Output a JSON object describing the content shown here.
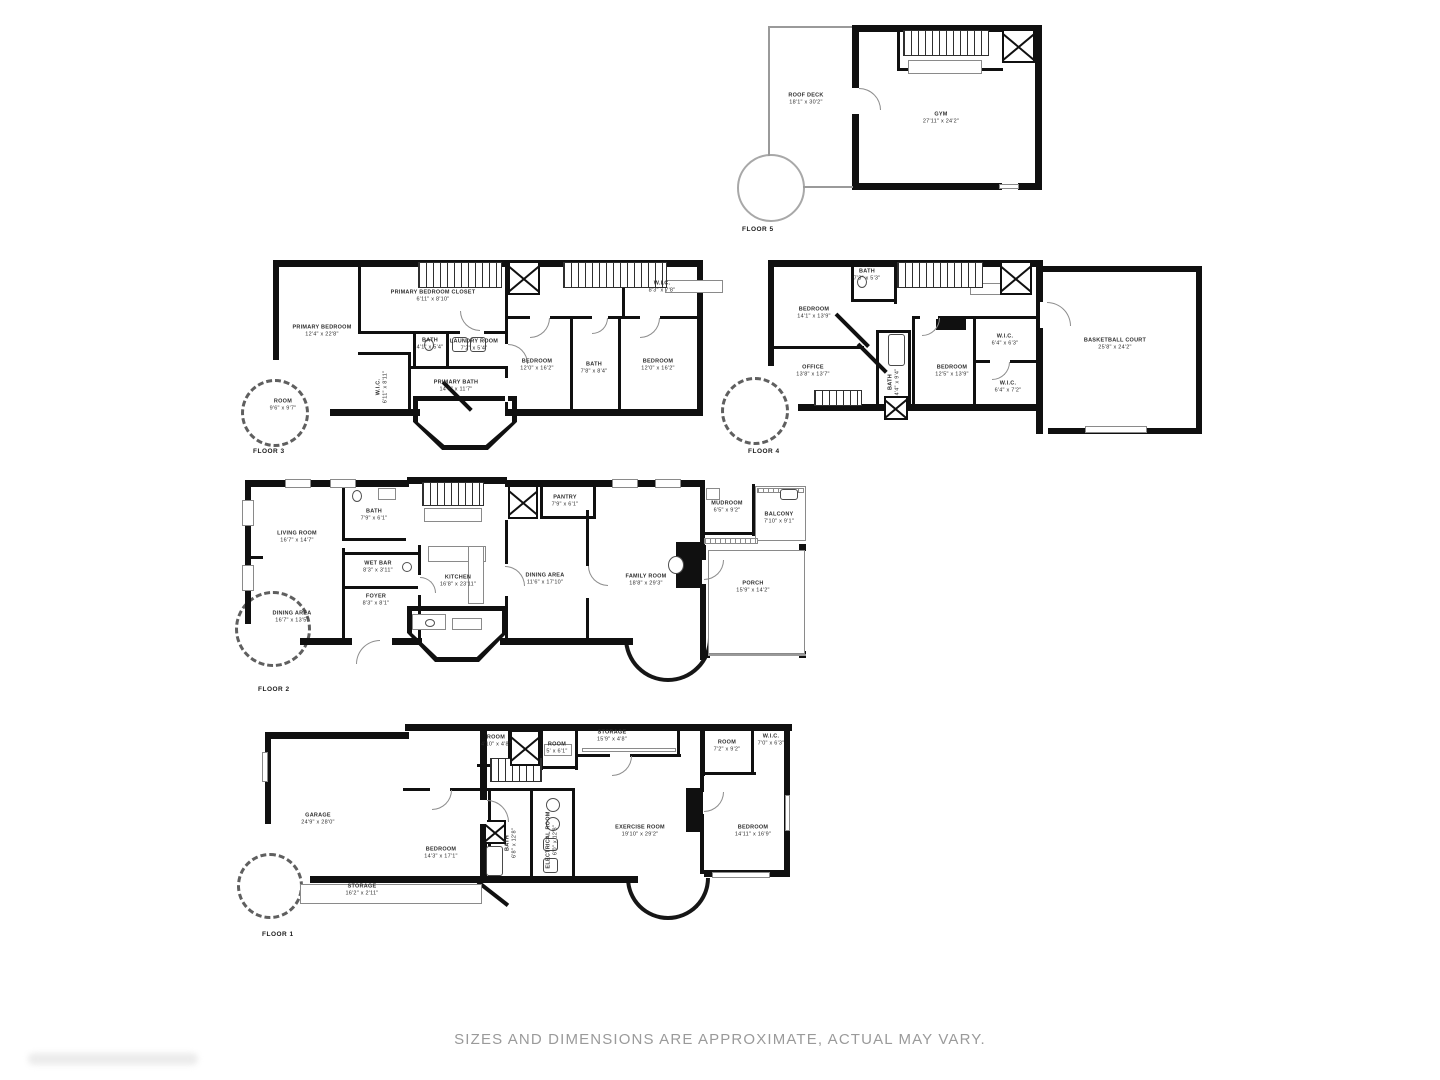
{
  "page": {
    "disclaimer": "SIZES AND DIMENSIONS ARE APPROXIMATE, ACTUAL MAY VARY."
  },
  "colors": {
    "wall": "#101010",
    "label": "#2d2d2d",
    "thin_line": "#9a9a9a",
    "disclaimer": "#9a9a9a",
    "background": "#ffffff"
  },
  "icons": {
    "elevator": "x-box-icon",
    "stairs": "hatched-stairs-icon",
    "door": "door-arc-icon",
    "bay_window": "bay-window-curve",
    "fixture": "bath-fixture-icon",
    "railing": "railing-grill-icon"
  },
  "floors": [
    {
      "id": "floor-5",
      "label": "FLOOR 5",
      "label_pos": [
        742,
        226
      ],
      "rooms": [
        {
          "name": "ROOF DECK",
          "dims": "18'1\" x 30'2\"",
          "x": 806,
          "y": 100
        },
        {
          "name": "GYM",
          "dims": "27'11\" x 24'2\"",
          "x": 941,
          "y": 119
        }
      ]
    },
    {
      "id": "floor-3",
      "label": "FLOOR 3",
      "label_pos": [
        253,
        448
      ],
      "rooms": [
        {
          "name": "PRIMARY BEDROOM",
          "dims": "12'4\" x 22'8\"",
          "x": 322,
          "y": 332
        },
        {
          "name": "PRIMARY BEDROOM CLOSET",
          "dims": "6'11\" x 8'10\"",
          "x": 433,
          "y": 297
        },
        {
          "name": "BATH",
          "dims": "4'1\" x 5'4\"",
          "x": 430,
          "y": 345
        },
        {
          "name": "LAUNDRY ROOM",
          "dims": "7'2\" x 5'4\"",
          "x": 474,
          "y": 346
        },
        {
          "name": "W.I.C.",
          "dims": "6'11\" x 8'11\"",
          "x": 383,
          "y": 387,
          "rot": true
        },
        {
          "name": "PRIMARY BATH",
          "dims": "14'6\" x 11'7\"",
          "x": 456,
          "y": 387
        },
        {
          "name": "ROOM",
          "dims": "9'6\" x 9'7\"",
          "x": 283,
          "y": 406
        },
        {
          "name": "BEDROOM",
          "dims": "12'0\" x 16'2\"",
          "x": 537,
          "y": 366
        },
        {
          "name": "BATH",
          "dims": "7'8\" x 8'4\"",
          "x": 594,
          "y": 369
        },
        {
          "name": "BEDROOM",
          "dims": "12'0\" x 16'2\"",
          "x": 658,
          "y": 366
        },
        {
          "name": "W.I.C.",
          "dims": "8'3\" x 7'8\"",
          "x": 662,
          "y": 288
        }
      ]
    },
    {
      "id": "floor-4",
      "label": "FLOOR 4",
      "label_pos": [
        748,
        448
      ],
      "rooms": [
        {
          "name": "BEDROOM",
          "dims": "14'1\" x 13'9\"",
          "x": 814,
          "y": 314
        },
        {
          "name": "BATH",
          "dims": "7'3\" x 5'3\"",
          "x": 867,
          "y": 276
        },
        {
          "name": "OFFICE",
          "dims": "13'8\" x 13'7\"",
          "x": 813,
          "y": 372
        },
        {
          "name": "BATH",
          "dims": "4'4\" x 9'4\"",
          "x": 895,
          "y": 382,
          "rot": true
        },
        {
          "name": "BEDROOM",
          "dims": "12'5\" x 13'9\"",
          "x": 952,
          "y": 372
        },
        {
          "name": "W.I.C.",
          "dims": "6'4\" x 6'3\"",
          "x": 1005,
          "y": 341
        },
        {
          "name": "W.I.C.",
          "dims": "6'4\" x 7'2\"",
          "x": 1008,
          "y": 388
        },
        {
          "name": "BASKETBALL COURT",
          "dims": "25'8\" x 24'2\"",
          "x": 1115,
          "y": 345
        }
      ]
    },
    {
      "id": "floor-2",
      "label": "FLOOR 2",
      "label_pos": [
        258,
        686
      ],
      "rooms": [
        {
          "name": "LIVING ROOM",
          "dims": "16'7\" x 14'7\"",
          "x": 297,
          "y": 538
        },
        {
          "name": "BATH",
          "dims": "7'9\" x 6'1\"",
          "x": 374,
          "y": 516
        },
        {
          "name": "WET BAR",
          "dims": "8'3\" x 3'11\"",
          "x": 378,
          "y": 568
        },
        {
          "name": "FOYER",
          "dims": "8'3\" x 8'1\"",
          "x": 376,
          "y": 601
        },
        {
          "name": "DINING AREA",
          "dims": "16'7\" x 13'5\"",
          "x": 292,
          "y": 618
        },
        {
          "name": "KITCHEN",
          "dims": "16'8\" x 23'11\"",
          "x": 458,
          "y": 582
        },
        {
          "name": "PANTRY",
          "dims": "7'9\" x 6'1\"",
          "x": 565,
          "y": 502
        },
        {
          "name": "DINING AREA",
          "dims": "11'6\" x 17'10\"",
          "x": 545,
          "y": 580
        },
        {
          "name": "FAMILY ROOM",
          "dims": "18'8\" x 29'3\"",
          "x": 646,
          "y": 581
        },
        {
          "name": "MUDROOM",
          "dims": "6'5\" x 9'2\"",
          "x": 727,
          "y": 508
        },
        {
          "name": "BALCONY",
          "dims": "7'10\" x 9'1\"",
          "x": 779,
          "y": 519
        },
        {
          "name": "PORCH",
          "dims": "15'9\" x 14'2\"",
          "x": 753,
          "y": 588
        }
      ]
    },
    {
      "id": "floor-1",
      "label": "FLOOR 1",
      "label_pos": [
        262,
        931
      ],
      "rooms": [
        {
          "name": "GARAGE",
          "dims": "24'9\" x 28'0\"",
          "x": 318,
          "y": 820
        },
        {
          "name": "ROOM",
          "dims": "4'10\" x 4'8\"",
          "x": 496,
          "y": 742
        },
        {
          "name": "ROOM",
          "dims": "5' x 6'1\"",
          "x": 557,
          "y": 749
        },
        {
          "name": "STORAGE",
          "dims": "15'9\" x 4'8\"",
          "x": 612,
          "y": 737
        },
        {
          "name": "BEDROOM",
          "dims": "14'3\" x 17'1\"",
          "x": 441,
          "y": 854
        },
        {
          "name": "BATH",
          "dims": "6'8\" x 12'8\"",
          "x": 512,
          "y": 843,
          "rot": true
        },
        {
          "name": "ELECTRICAL ROOM",
          "dims": "6'0\" x 12'8\"",
          "x": 553,
          "y": 840,
          "rot": true
        },
        {
          "name": "EXERCISE ROOM",
          "dims": "19'10\" x 29'2\"",
          "x": 640,
          "y": 832
        },
        {
          "name": "ROOM",
          "dims": "7'2\" x 9'2\"",
          "x": 727,
          "y": 747
        },
        {
          "name": "W.I.C.",
          "dims": "7'0\" x 6'3\"",
          "x": 771,
          "y": 741
        },
        {
          "name": "BEDROOM",
          "dims": "14'11\" x 16'9\"",
          "x": 753,
          "y": 832
        },
        {
          "name": "STORAGE",
          "dims": "16'2\" x 2'11\"",
          "x": 362,
          "y": 891
        }
      ]
    }
  ]
}
